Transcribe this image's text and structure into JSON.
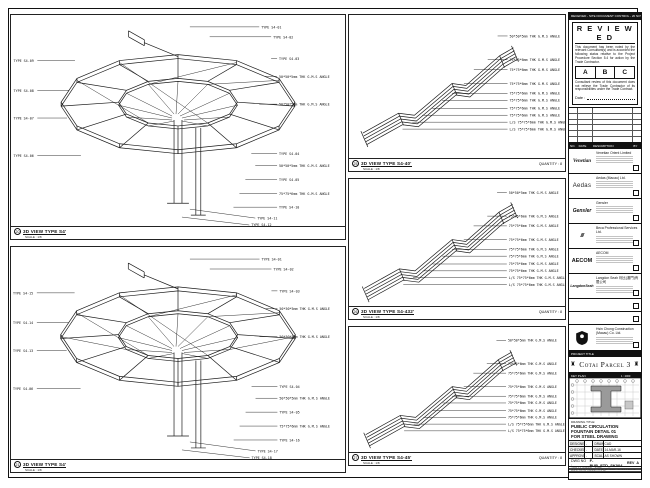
{
  "sheet": {
    "doc_control_strip": "RECEIVED - SITE DOCUMENT CONTROL - 20 NOV 2015"
  },
  "stamp": {
    "title": "R E V I E W E D",
    "para1": "This document has been noted by the relevant Consultant(s) and is accorded the following status relative to the Project Procedure Section 5.4 for action by the Trade Contractor.",
    "grades": [
      "A",
      "B",
      "C"
    ],
    "para2": "Consultant review of this document does not relieve the Trade Contractor of its responsibilities under the Trade Contract.",
    "date_label": "Date :"
  },
  "revision_table": {
    "headers": [
      "NO.",
      "DATE",
      "DESCRIPTION",
      "BY"
    ]
  },
  "consultants": [
    {
      "logo": "Venetian",
      "name": "Venetian Orient Limited"
    },
    {
      "logo": "Aedas",
      "name": "Aedas (Macau) Ltd."
    },
    {
      "logo": "Gensler",
      "name": "Gensler"
    },
    {
      "logo": "///",
      "name": "Beca Professional Services Ltd."
    },
    {
      "logo": "AECOM",
      "name": "AECOM"
    },
    {
      "logo": "LangdonSeah",
      "name": "Langdon Seah 利比(澳門)有限公司"
    },
    {
      "logo": "",
      "name": ""
    },
    {
      "logo": "",
      "name": ""
    },
    {
      "logo": "HC",
      "name": "Hsin Chong Construction (Macau) Co. Ltd."
    }
  ],
  "project": {
    "strip_label": "PROJECT TITLE",
    "name": "Cotai Parcel 3",
    "ornament": "♜"
  },
  "key_plan": {
    "label": "KEY PLAN",
    "scale": "1 : 2000"
  },
  "title_block": {
    "drawing_title_label": "DRAWING TITLE:",
    "line1": "PUBLIC CIRCULATION",
    "line2": "FOUNTAIN DETAIL 01",
    "line3": "FOR STEEL DRAWING",
    "designed_label": "DESIGNED",
    "designed": "-",
    "drawn_label": "DRAWN",
    "drawn": "CAD",
    "checked_label": "CHECKED",
    "checked": "-",
    "date_label": "DATE",
    "date": "14-MAR-16",
    "approved_label": "APPROVED",
    "approved": "-",
    "scale_label": "SCALE",
    "scale": "AS SHOWN",
    "dwg_no_label": "DWG NO :",
    "dwg_no": "F-PUB_FTD_SK004",
    "rev_label": "REV",
    "rev": "A",
    "job_label": "JOB NUMBER :",
    "job": "3162",
    "cad_label": "CAD FILE NAME :",
    "cad": "F-PUB_FTD_SK004.DWG",
    "xref_label": "DRAWING XREF NAME :"
  },
  "viewports": {
    "left_top": {
      "bubble": "20",
      "title": "3D VIEW TYPE S4'",
      "scale": "SCALE : 1/8",
      "callouts_top": [
        "TYPE S4-01",
        "TYPE S4-02"
      ],
      "callouts_left": [
        "TYPE S4-09",
        "TYPE S4-08",
        "TYPE S4-07",
        "TYPE S4-06"
      ],
      "callouts_right": [
        "TYPE S4-03",
        "50*50*5mm THK G.M.S ANGLE",
        "50*50*5mm THK G.M.S ANGLE",
        "TYPE S4-04",
        "50*50*5mm THK G.M.S ANGLE",
        "TYPE S4-05",
        "75*75*6mm THK G.M.S ANGLE",
        "TYPE S4-10"
      ],
      "callouts_bottom": [
        "TYPE S4-11",
        "TYPE S4-12"
      ]
    },
    "left_bottom": {
      "bubble": "21",
      "title": "3D VIEW TYPE S4'",
      "scale": "SCALE : 1/8",
      "callouts_top": [
        "TYPE S4-01",
        "TYPE S4-02"
      ],
      "callouts_left": [
        "TYPE S4-15",
        "TYPE S4-14",
        "TYPE S4-13",
        "TYPE S4-06"
      ],
      "callouts_right": [
        "TYPE S4-03",
        "50*50*5mm THK G.M.S ANGLE",
        "50*50*5mm THK G.M.S ANGLE",
        "TYPE S4-04",
        "50*50*5mm THK G.M.S ANGLE",
        "TYPE S4-05",
        "75*75*6mm THK G.M.S ANGLE",
        "TYPE S4-16"
      ],
      "callouts_bottom": [
        "TYPE S4-17",
        "TYPE S4-18"
      ]
    },
    "mid_top": {
      "bubble": "25",
      "title": "3D VIEW TYPE S4-40'",
      "scale": "SCALE : 1/8",
      "quantity": "QUANTITY : 8",
      "callouts": [
        "50*50*5mm THK G.M.S ANGLE",
        "75*75*6mm THK G.M.S ANGLE",
        "75*75*6mm THK G.M.S ANGLE",
        "75*75*6mm THK G.M.S ANGLE",
        "75*75*6mm THK G.M.S ANGLE",
        "75*75*6mm THK G.M.S ANGLE",
        "75*75*6mm THK G.M.S ANGLE",
        "75*75*6mm THK G.M.S ANGLE",
        "L/S 75*75*6mm THK G.M.S ANGLE",
        "L/S 75*75*6mm THK G.M.S ANGLE"
      ]
    },
    "mid_mid": {
      "bubble": "26",
      "title": "3D VIEW TYPE S4-432'",
      "scale": "SCALE : 1/8",
      "quantity": "QUANTITY : 8",
      "callouts": [
        "50*50*5mm THK G.M.S ANGLE",
        "75*75*6mm THK G.M.S ANGLE",
        "75*75*6mm THK G.M.S ANGLE",
        "75*75*6mm THK G.M.S ANGLE",
        "75*75*6mm THK G.M.S ANGLE",
        "75*75*6mm THK G.M.S ANGLE",
        "75*75*6mm THK G.M.S ANGLE",
        "75*75*6mm THK G.M.S ANGLE",
        "L/S 75*75*6mm THK G.M.S ANGLE",
        "L/S 75*75*6mm THK G.M.S ANGLE"
      ]
    },
    "mid_bottom": {
      "bubble": "27",
      "title": "3D VIEW TYPE S4-45'",
      "scale": "SCALE : 1/8",
      "quantity": "QUANTITY : 8",
      "callouts": [
        "50*50*5mm THK G.M.S ANGLE",
        "75*75*6mm THK G.M.S ANGLE",
        "75*75*6mm THK G.M.S ANGLE",
        "75*75*6mm THK G.M.S ANGLE",
        "75*75*6mm THK G.M.S ANGLE",
        "75*75*6mm THK G.M.S ANGLE",
        "75*75*6mm THK G.M.S ANGLE",
        "75*75*6mm THK G.M.S ANGLE",
        "L/S 75*75*6mm THK G.M.S ANGLE",
        "L/S 75*75*6mm THK G.M.S ANGLE"
      ]
    }
  }
}
